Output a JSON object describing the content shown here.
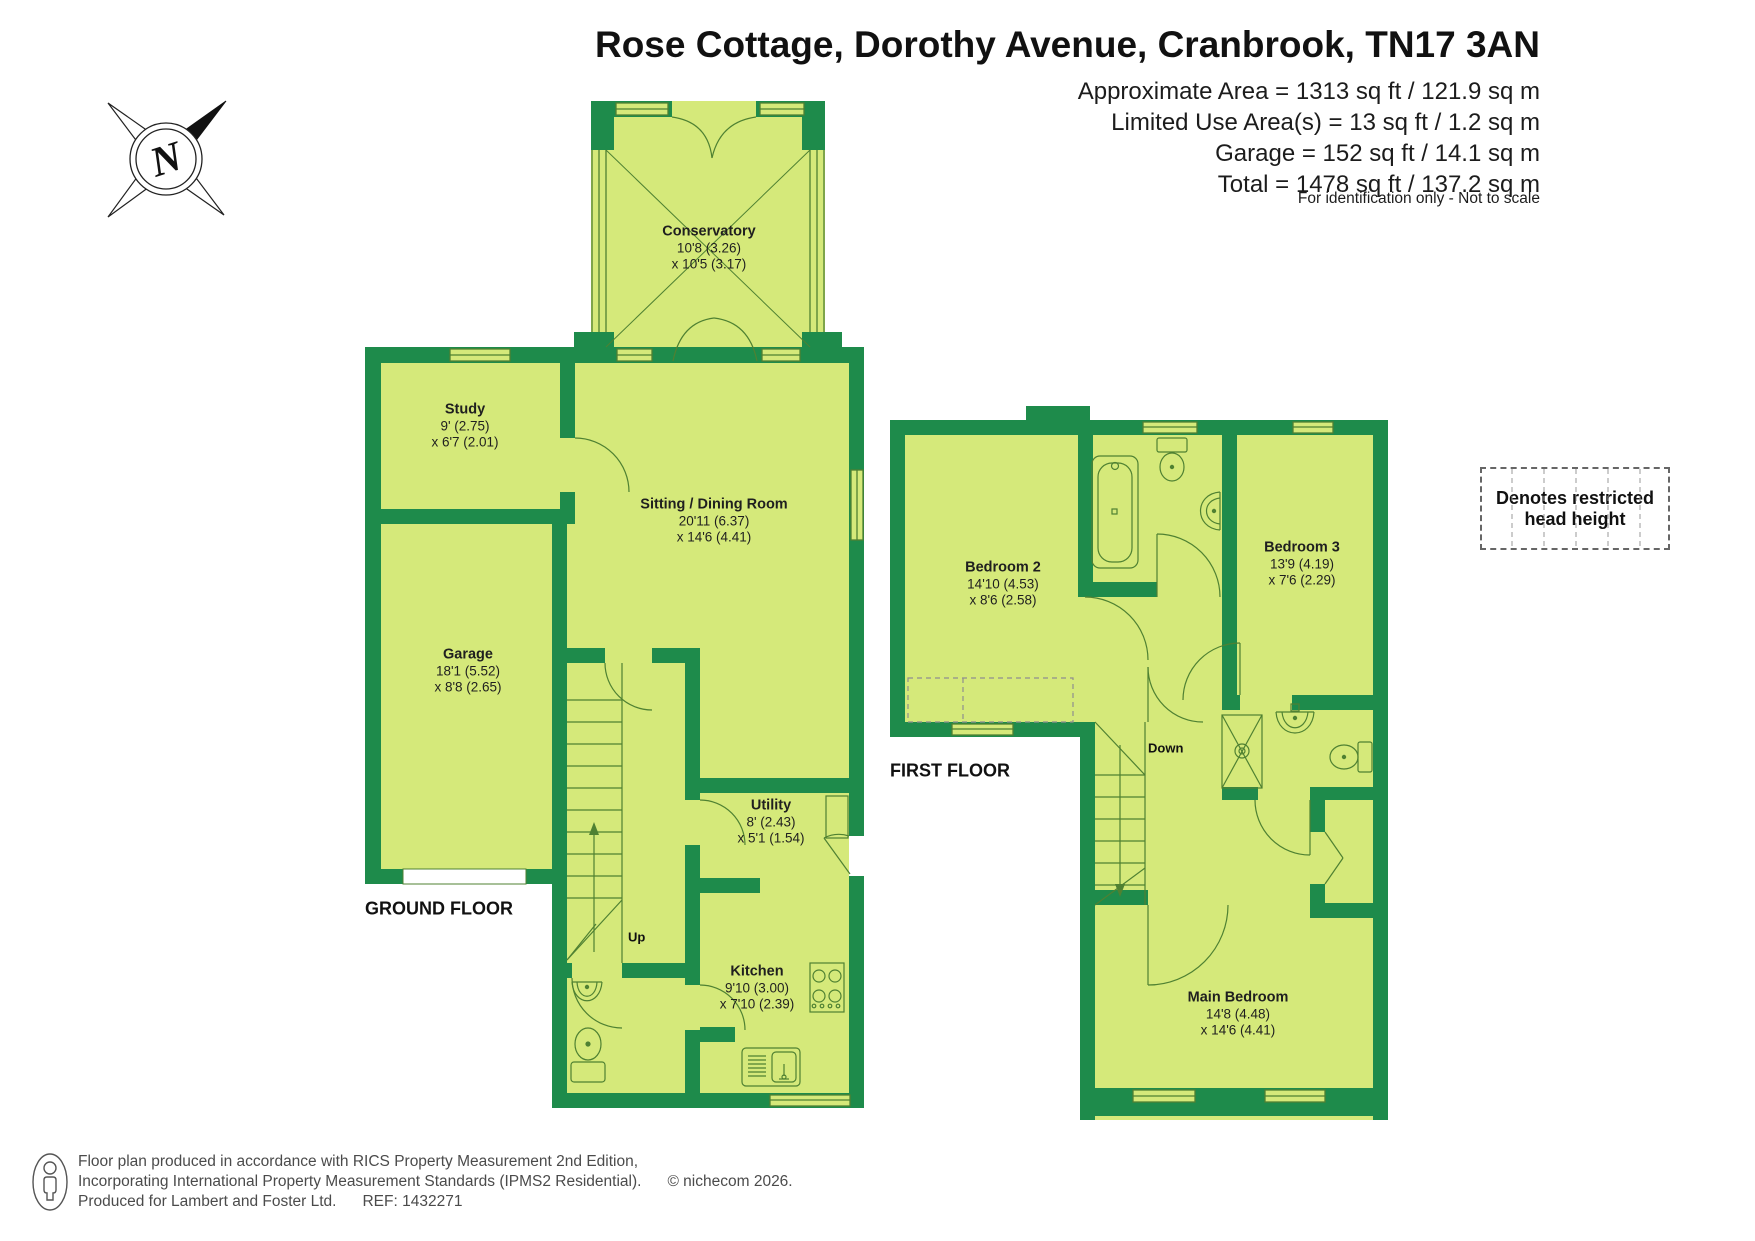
{
  "header": {
    "title": "Rose Cottage, Dorothy Avenue, Cranbrook, TN17 3AN",
    "area_lines": [
      "Approximate Area = 1313 sq ft / 121.9 sq m",
      "Limited Use Area(s) = 13 sq ft / 1.2 sq m",
      "Garage = 152 sq ft / 14.1 sq m",
      "Total = 1478 sq ft / 137.2 sq m"
    ],
    "disclaimer": "For identification only - Not to scale"
  },
  "compass": {
    "letter": "N"
  },
  "floors": {
    "ground": {
      "label": "GROUND FLOOR"
    },
    "first": {
      "label": "FIRST FLOOR"
    }
  },
  "rooms": {
    "conservatory": {
      "name": "Conservatory",
      "dim1": "10'8 (3.26)",
      "dim2": "x 10'5 (3.17)"
    },
    "study": {
      "name": "Study",
      "dim1": "9' (2.75)",
      "dim2": "x 6'7 (2.01)"
    },
    "sitting": {
      "name": "Sitting / Dining Room",
      "dim1": "20'11 (6.37)",
      "dim2": "x 14'6 (4.41)"
    },
    "garage": {
      "name": "Garage",
      "dim1": "18'1 (5.52)",
      "dim2": "x 8'8 (2.65)"
    },
    "utility": {
      "name": "Utility",
      "dim1": "8' (2.43)",
      "dim2": "x 5'1 (1.54)"
    },
    "kitchen": {
      "name": "Kitchen",
      "dim1": "9'10 (3.00)",
      "dim2": "x 7'10 (2.39)"
    },
    "bedroom2": {
      "name": "Bedroom 2",
      "dim1": "14'10 (4.53)",
      "dim2": "x 8'6 (2.58)"
    },
    "bedroom3": {
      "name": "Bedroom 3",
      "dim1": "13'9 (4.19)",
      "dim2": "x 7'6 (2.29)"
    },
    "main_bedroom": {
      "name": "Main Bedroom",
      "dim1": "14'8 (4.48)",
      "dim2": "x 14'6 (4.41)"
    }
  },
  "stairs": {
    "up": "Up",
    "down": "Down"
  },
  "legend": {
    "line1": "Denotes restricted",
    "line2": "head height"
  },
  "footer": {
    "line1": "Floor plan produced in accordance with RICS Property Measurement 2nd Edition,",
    "line2": "Incorporating International Property Measurement Standards (IPMS2 Residential).",
    "copyright": "© nichecom 2026.",
    "line3": "Produced for Lambert and Foster Ltd.",
    "ref": "REF: 1432271"
  },
  "colors": {
    "wall": "#1e8b4b",
    "room": "#d5e97a",
    "line": "#4f8132"
  }
}
